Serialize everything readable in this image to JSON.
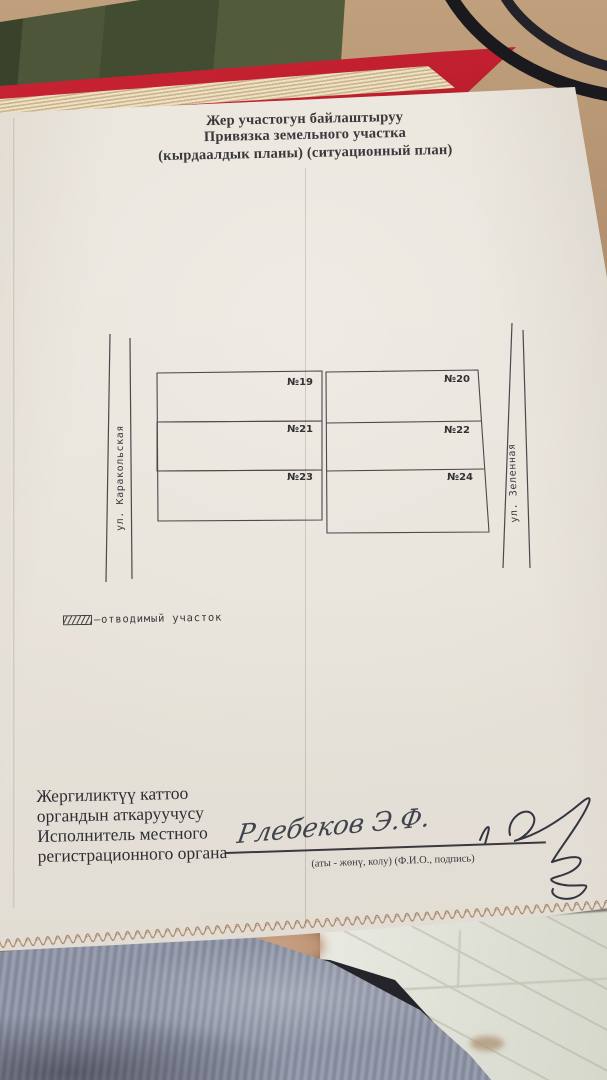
{
  "photo": {
    "description": "photo of a paper land-plot plan lying over books on a tan desk, striped shirt and tiled floor visible below",
    "colors": {
      "desk": "#b2906c",
      "book_green": "#4a5236",
      "book_red": "#c2202f",
      "page_edges": "#e7d8b6",
      "cable": "#1a191d",
      "paper": "#e8e3da",
      "ink": "#3b3a3c",
      "floor": "#e2e3da",
      "shirt": "#9aa0af",
      "thread": "#a07c5e"
    }
  },
  "document": {
    "title": {
      "line1": "Жер участогун байлаштыруу",
      "line2": "Привязка земельного участка",
      "line3": "(кырдаалдык планы) (ситуационный план)"
    },
    "plan": {
      "street_left": "ул. Каракольская",
      "street_right": "ул. Зеленная",
      "plots": [
        {
          "id": "№19",
          "hatched": false
        },
        {
          "id": "№20",
          "hatched": false
        },
        {
          "id": "№21",
          "hatched": true
        },
        {
          "id": "№22",
          "hatched": false
        },
        {
          "id": "№23",
          "hatched": false
        },
        {
          "id": "№24",
          "hatched": false
        }
      ]
    },
    "legend": {
      "swatch": "hatched-rectangle",
      "label": "–отводимый  участок"
    },
    "signature_block": {
      "lines": [
        "Жергиликтүү каттоо",
        "органдын аткаруучусу",
        "Исполнитель местного",
        "регистрационного органа"
      ],
      "caption": "(аты - жөнү, колу) (Ф.И.О., подпись)",
      "name": "Рлебеков Э.Ф."
    }
  }
}
